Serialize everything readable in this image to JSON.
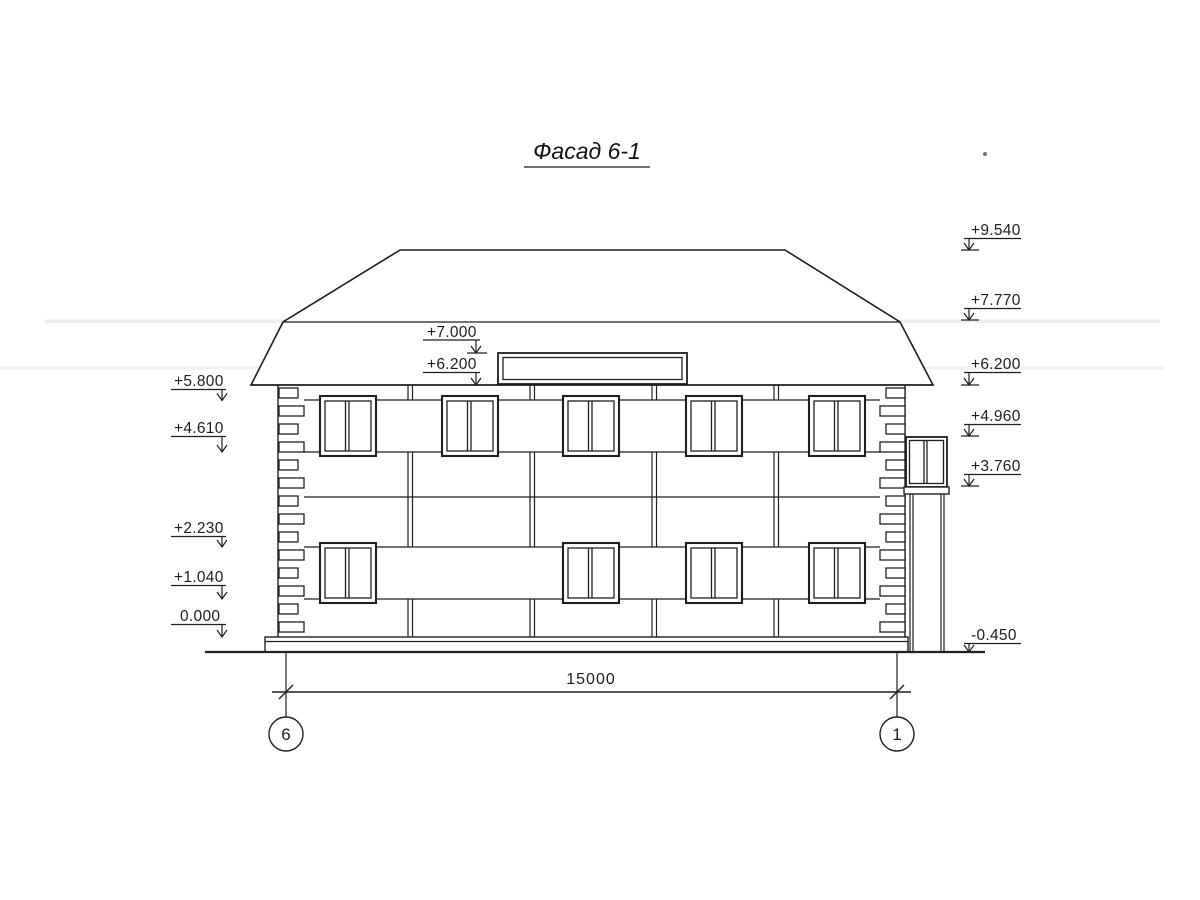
{
  "page": {
    "background": "#ffffff",
    "ink": "#1f1f1f"
  },
  "title": "Фасад 6-1",
  "levels": {
    "left": [
      {
        "value": "+5.800"
      },
      {
        "value": "+4.610"
      },
      {
        "value": "+2.230"
      },
      {
        "value": "+1.040"
      },
      {
        "value": "0.000"
      }
    ],
    "middle": [
      {
        "value": "+7.000"
      },
      {
        "value": "+6.200"
      }
    ],
    "right": [
      {
        "value": "+9.540"
      },
      {
        "value": "+7.770"
      },
      {
        "value": "+6.200"
      },
      {
        "value": "+4.960"
      },
      {
        "value": "+3.760"
      },
      {
        "value": "-0.450"
      }
    ]
  },
  "dimensions": {
    "overall_width": "15000"
  },
  "axes": {
    "left": "6",
    "right": "1"
  }
}
